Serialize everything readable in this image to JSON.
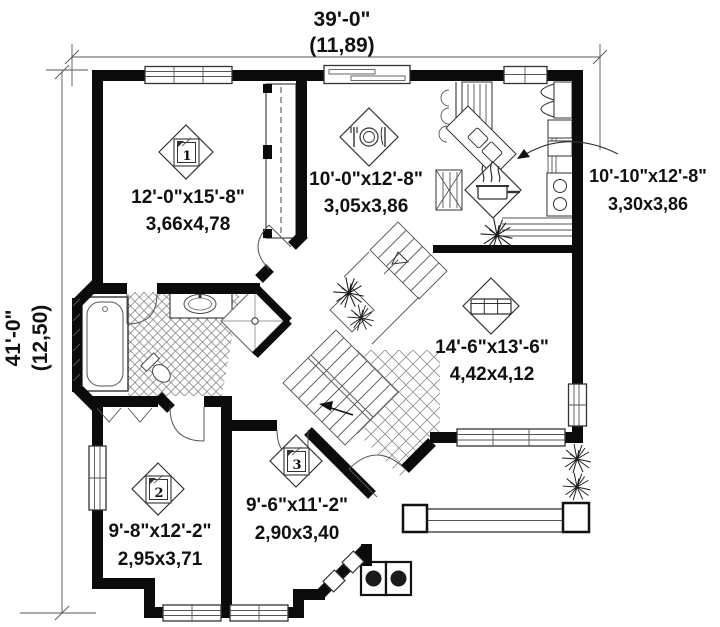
{
  "plan": {
    "dimensions": {
      "width_feet": "39'-0\"",
      "width_meters": "(11,89)",
      "height_feet": "41'-0\"",
      "height_meters": "(12,50)"
    },
    "rooms": [
      {
        "name": "bedroom-1",
        "badge": "1",
        "icon": "bed",
        "size_imperial": "12'-0\"x15'-8\"",
        "size_metric": "3,66x4,78"
      },
      {
        "name": "dining",
        "badge": "",
        "icon": "dining",
        "size_imperial": "10'-0\"x12'-8\"",
        "size_metric": "3,05x3,86"
      },
      {
        "name": "kitchen",
        "badge": "",
        "icon": "cooking-pot",
        "size_imperial": "10'-10\"x12'-8\"",
        "size_metric": "3,30x3,86"
      },
      {
        "name": "living",
        "badge": "",
        "icon": "sofa",
        "size_imperial": "14'-6\"x13'-6\"",
        "size_metric": "4,42x4,12"
      },
      {
        "name": "bedroom-2",
        "badge": "2",
        "icon": "bed",
        "size_imperial": "9'-8\"x12'-2\"",
        "size_metric": "2,95x3,71"
      },
      {
        "name": "bedroom-3",
        "badge": "3",
        "icon": "bed",
        "size_imperial": "9'-6\"x11'-2\"",
        "size_metric": "2,90x3,40"
      }
    ],
    "colors": {
      "wall": "#0b0b0b",
      "line": "#333333",
      "text": "#111111",
      "background": "#ffffff"
    }
  }
}
